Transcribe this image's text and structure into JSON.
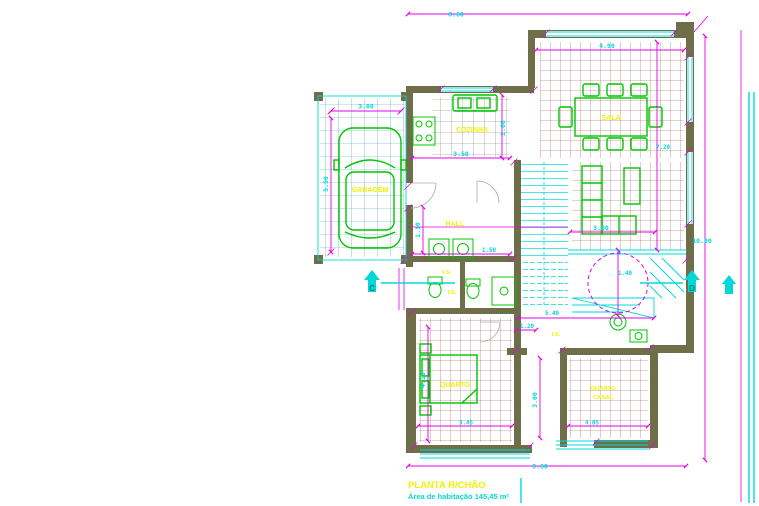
{
  "colors": {
    "dim": "#e400e4",
    "cyan": "#00d8d8",
    "green": "#00c400",
    "yellow": "#f2f200",
    "wall": "#6e6e48",
    "hatch_red": "#9a4848",
    "hatch_olive": "#7a7a62",
    "hatch_teal": "#2fa8a8",
    "door": "#aaaaaa",
    "marker_text": "#007a7a"
  },
  "title_block": {
    "title": "PLANTA R/CHÃO",
    "subtitle": "Área de habitação 145,45 m²"
  },
  "section_markers": {
    "left": "C",
    "right": "D"
  },
  "room_labels": {
    "garage": "GARAGEM",
    "kitchen": "COZINHA",
    "dining": "SALA",
    "hall": "HALL",
    "wc_top": "I.S.",
    "wc_bottom": "I.S.",
    "bath": "I.S.",
    "bedroom": "QUARTO",
    "bedroom2_line1": "QUARTO",
    "bedroom2_line2": "CASAL"
  },
  "dimensions": {
    "overall_width_top": "8.60",
    "overall_width_bottom": "8.60",
    "overall_height_right": "10.00",
    "dining_width": "4.90",
    "dining_height": "7.20",
    "garage_width": "3.00",
    "garage_depth": "5.50",
    "kitchen_width": "3.50",
    "kitchen_depth": "2.60",
    "living_width": "3.00",
    "hall_width": "1.10",
    "wc_width": "1.50",
    "stair_run": "5.40",
    "stair_width": "1.20",
    "stair_radius": "1.40",
    "bedroom_depth": "4.10",
    "bedroom_width": "3.45",
    "void_depth": "3.00",
    "bedroom2_width": "4.05"
  }
}
